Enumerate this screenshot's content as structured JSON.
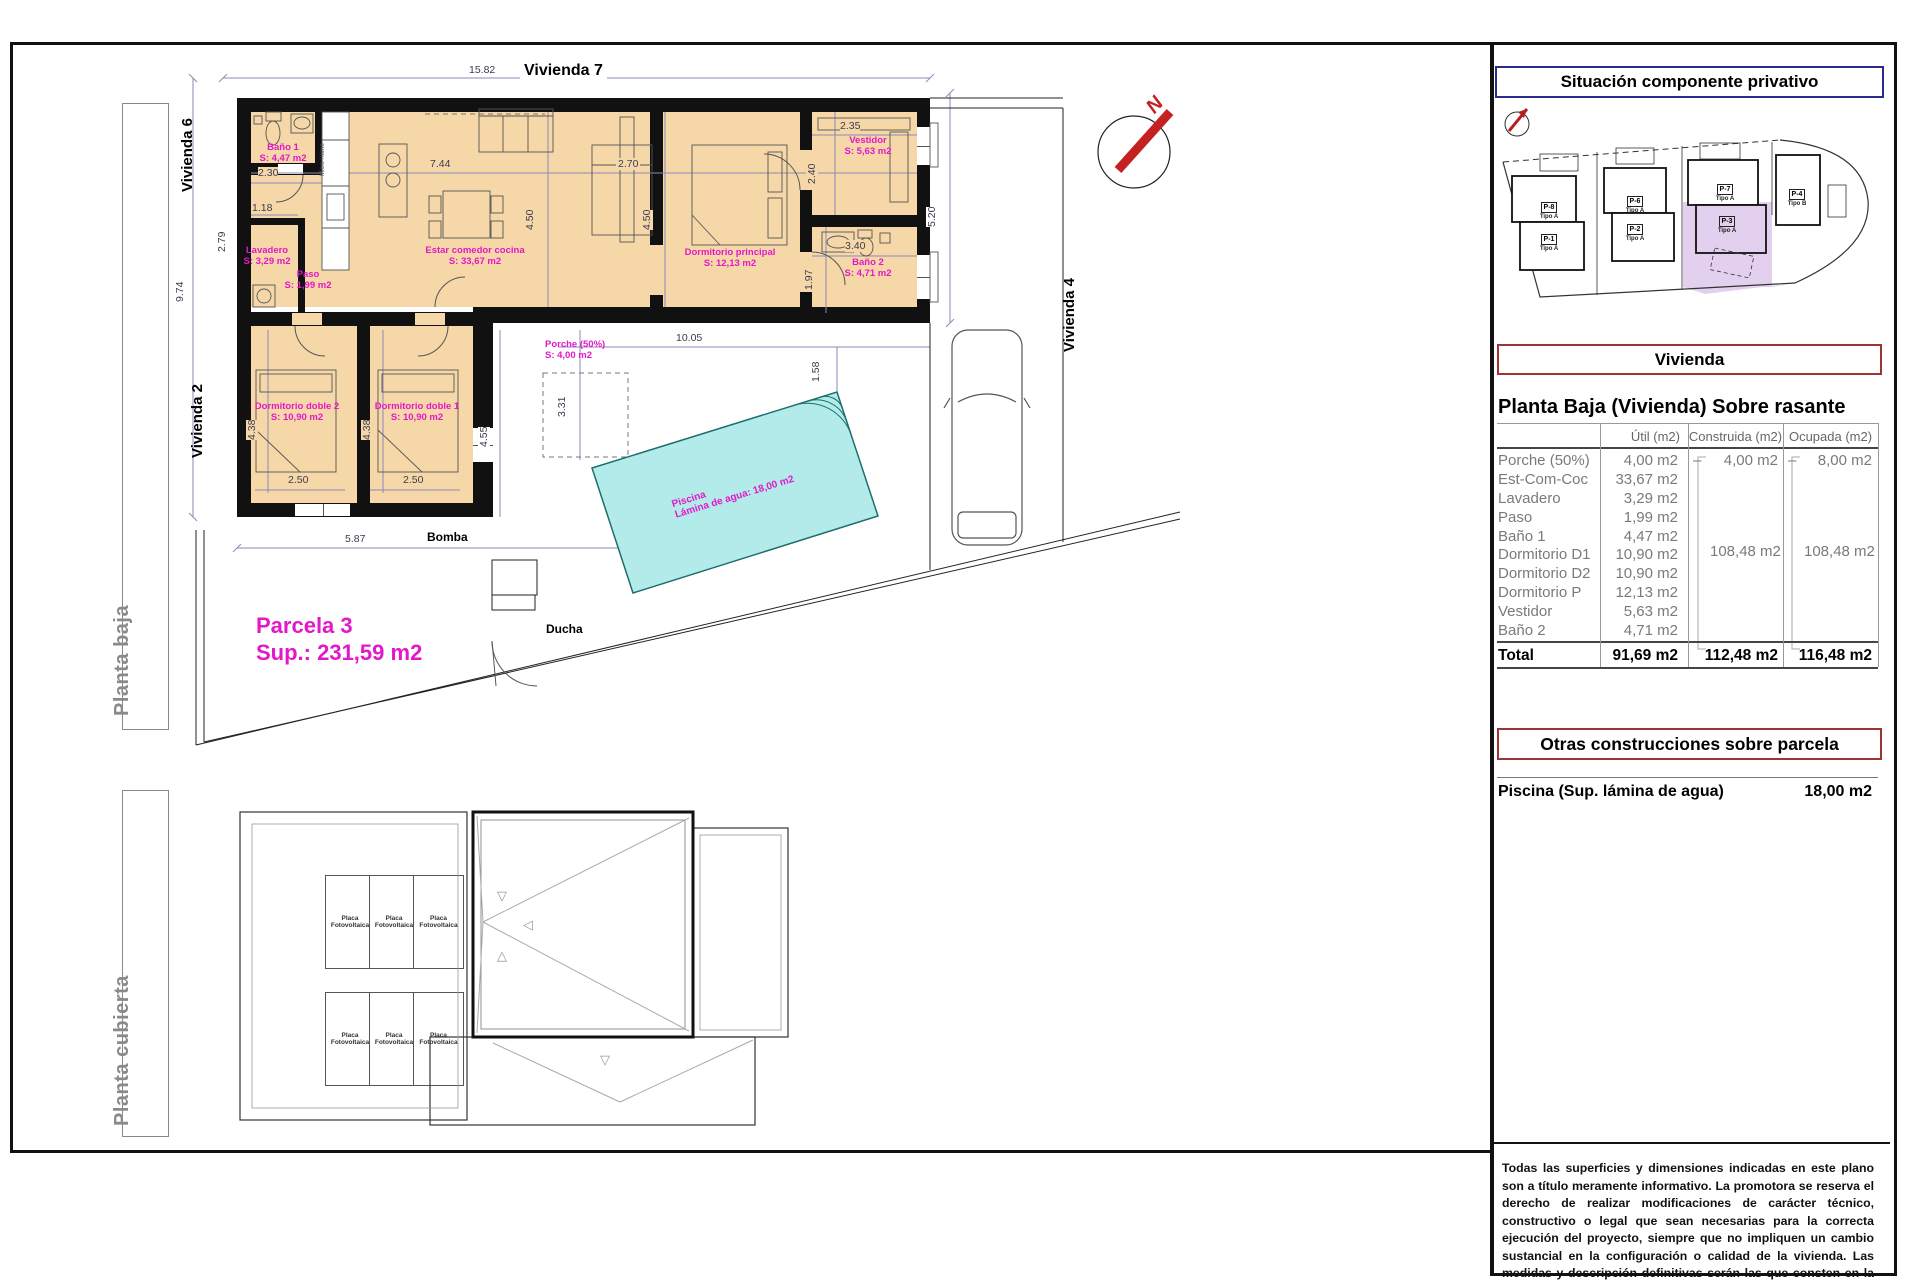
{
  "plan": {
    "labels": {
      "vivienda7": "Vivienda 7",
      "vivienda6": "Vivienda 6",
      "vivienda2": "Vivienda 2",
      "vivienda4": "Vivienda 4",
      "bomba": "Bomba",
      "ducha": "Ducha",
      "micro": "Micro Horno",
      "north": "N",
      "planta_baja": "Planta baja",
      "planta_cubierta": "Planta cubierta",
      "placa": "Placa Fotovoltaica",
      "parcela_name": "Parcela 3",
      "parcela_sup": "Sup.: 231,59 m2",
      "piscina_line1": "Piscina",
      "piscina_line2": "Lámina de agua: 18,00 m2"
    },
    "rooms": [
      {
        "name": "Baño 1",
        "area": "S: 4,47 m2"
      },
      {
        "name": "Lavadero",
        "area": "S: 3,29 m2"
      },
      {
        "name": "Paso",
        "area": "S: 1,99 m2"
      },
      {
        "name": "Estar comedor cocina",
        "area": "S: 33,67 m2"
      },
      {
        "name": "Dormitorio principal",
        "area": "S: 12,13 m2"
      },
      {
        "name": "Vestidor",
        "area": "S: 5,63 m2"
      },
      {
        "name": "Baño 2",
        "area": "S: 4,71 m2"
      },
      {
        "name": "Dormitorio doble 2",
        "area": "S: 10,90 m2"
      },
      {
        "name": "Dormitorio doble 1",
        "area": "S: 10,90 m2"
      },
      {
        "name": "Porche (50%)",
        "area": "S: 4,00 m2"
      }
    ],
    "dims": [
      "15.82",
      "9.74",
      "2.30",
      "1.18",
      "2.79",
      "7.44",
      "4.50",
      "2.70",
      "4.50",
      "2.35",
      "2.40",
      "3.40",
      "1.97",
      "5.20",
      "10.05",
      "1.58",
      "4.38",
      "4.38",
      "2.50",
      "2.50",
      "5.87",
      "4.55",
      "3.31"
    ],
    "roof_markers": [
      "▽",
      "◁",
      "△",
      "▽"
    ]
  },
  "panel": {
    "situacion_title": "Situación componente privativo",
    "parcels": [
      {
        "id": "P-8",
        "tipo": "Tipo A"
      },
      {
        "id": "P-1",
        "tipo": "Tipo A"
      },
      {
        "id": "P-6",
        "tipo": "Tipo A"
      },
      {
        "id": "P-2",
        "tipo": "Tipo A"
      },
      {
        "id": "P-7",
        "tipo": "Tipo A"
      },
      {
        "id": "P-3",
        "tipo": "Tipo A"
      },
      {
        "id": "P-4",
        "tipo": "Tipo B"
      }
    ],
    "vivienda_title": "Vivienda",
    "section_title": "Planta Baja (Vivienda) Sobre rasante",
    "table": {
      "headers": [
        "Útil (m2)",
        "Construida (m2)",
        "Ocupada (m2)"
      ],
      "rows": [
        {
          "label": "Porche (50%)",
          "util": "4,00 m2"
        },
        {
          "label": "Est-Com-Coc",
          "util": "33,67 m2"
        },
        {
          "label": "Lavadero",
          "util": "3,29 m2"
        },
        {
          "label": "Paso",
          "util": "1,99 m2"
        },
        {
          "label": "Baño 1",
          "util": "4,47 m2"
        },
        {
          "label": "Dormitorio D1",
          "util": "10,90 m2"
        },
        {
          "label": "Dormitorio D2",
          "util": "10,90 m2"
        },
        {
          "label": "Dormitorio P",
          "util": "12,13 m2"
        },
        {
          "label": "Vestidor",
          "util": "5,63 m2"
        },
        {
          "label": "Baño 2",
          "util": "4,71 m2"
        }
      ],
      "dash": "–",
      "porche_construida": "4,00 m2",
      "porche_ocupada": "8,00 m2",
      "group_construida": "108,48 m2",
      "group_ocupada": "108,48 m2",
      "total_label": "Total",
      "total_util": "91,69 m2",
      "total_construida": "112,48 m2",
      "total_ocupada": "116,48 m2"
    },
    "otras_title": "Otras construcciones sobre parcela",
    "piscina_label": "Piscina (Sup. lámina de agua)",
    "piscina_value": "18,00 m2",
    "disclaimer": "Todas las superficies y dimensiones indicadas en este plano son a título meramente informativo. La promotora se reserva el derecho de realizar modificaciones de carácter técnico, constructivo o legal que sean necesarias para la correcta ejecución del proyecto, siempre que no impliquen un cambio sustancial en la configuración o calidad de la vivienda. Las medidas y descripción definitivas serán las que consten en la Escritura Pública de Obra Nueva y División Horizontal. Los elementos de mobiliario y decoración son ilustrativos y no están incluidos."
  },
  "colors": {
    "accent_magenta": "#E318C9",
    "room_fill": "#F5D7A8",
    "pool_fill": "#B2EBEA",
    "highlight_purple": "#E2D0EE",
    "title_red_border": "#A03434",
    "title_navy_border": "#2B2B8C",
    "north_red": "#C42222",
    "wall_black": "#111111"
  }
}
